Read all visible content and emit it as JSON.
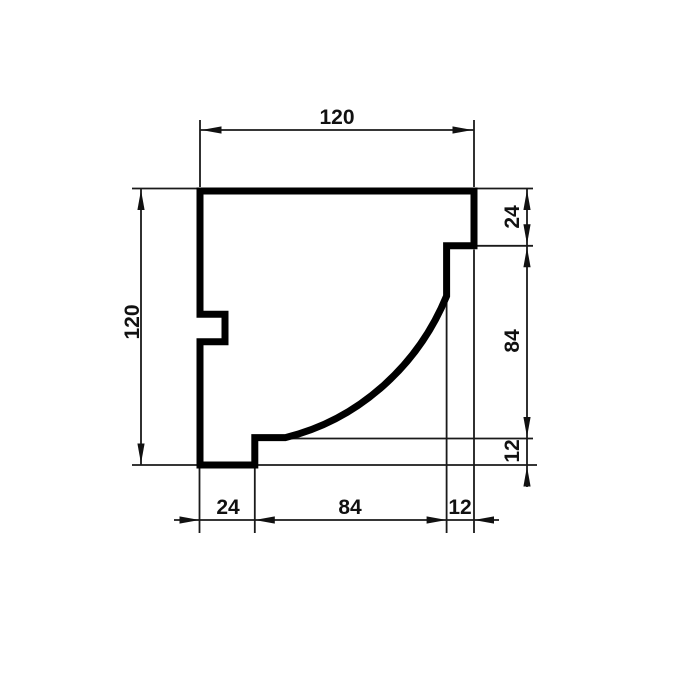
{
  "drawing": {
    "kind": "technical-cross-section-profile",
    "colors": {
      "background": "#ffffff",
      "outline": "#000000",
      "dimension_lines": "#1a1a1a",
      "text": "#111111"
    },
    "profile": {
      "overall_width": 120,
      "overall_height": 120,
      "right_segments_top_to_bottom": [
        24,
        84,
        12
      ],
      "bottom_segments_left_to_right": [
        24,
        84,
        12
      ]
    },
    "dims": {
      "top_width": {
        "label": "120"
      },
      "left_height": {
        "label": "120"
      },
      "right_top": {
        "label": "24"
      },
      "right_mid": {
        "label": "84"
      },
      "right_bottom": {
        "label": "12"
      },
      "bottom_left": {
        "label": "24"
      },
      "bottom_mid": {
        "label": "84"
      },
      "bottom_right": {
        "label": "12"
      }
    }
  }
}
